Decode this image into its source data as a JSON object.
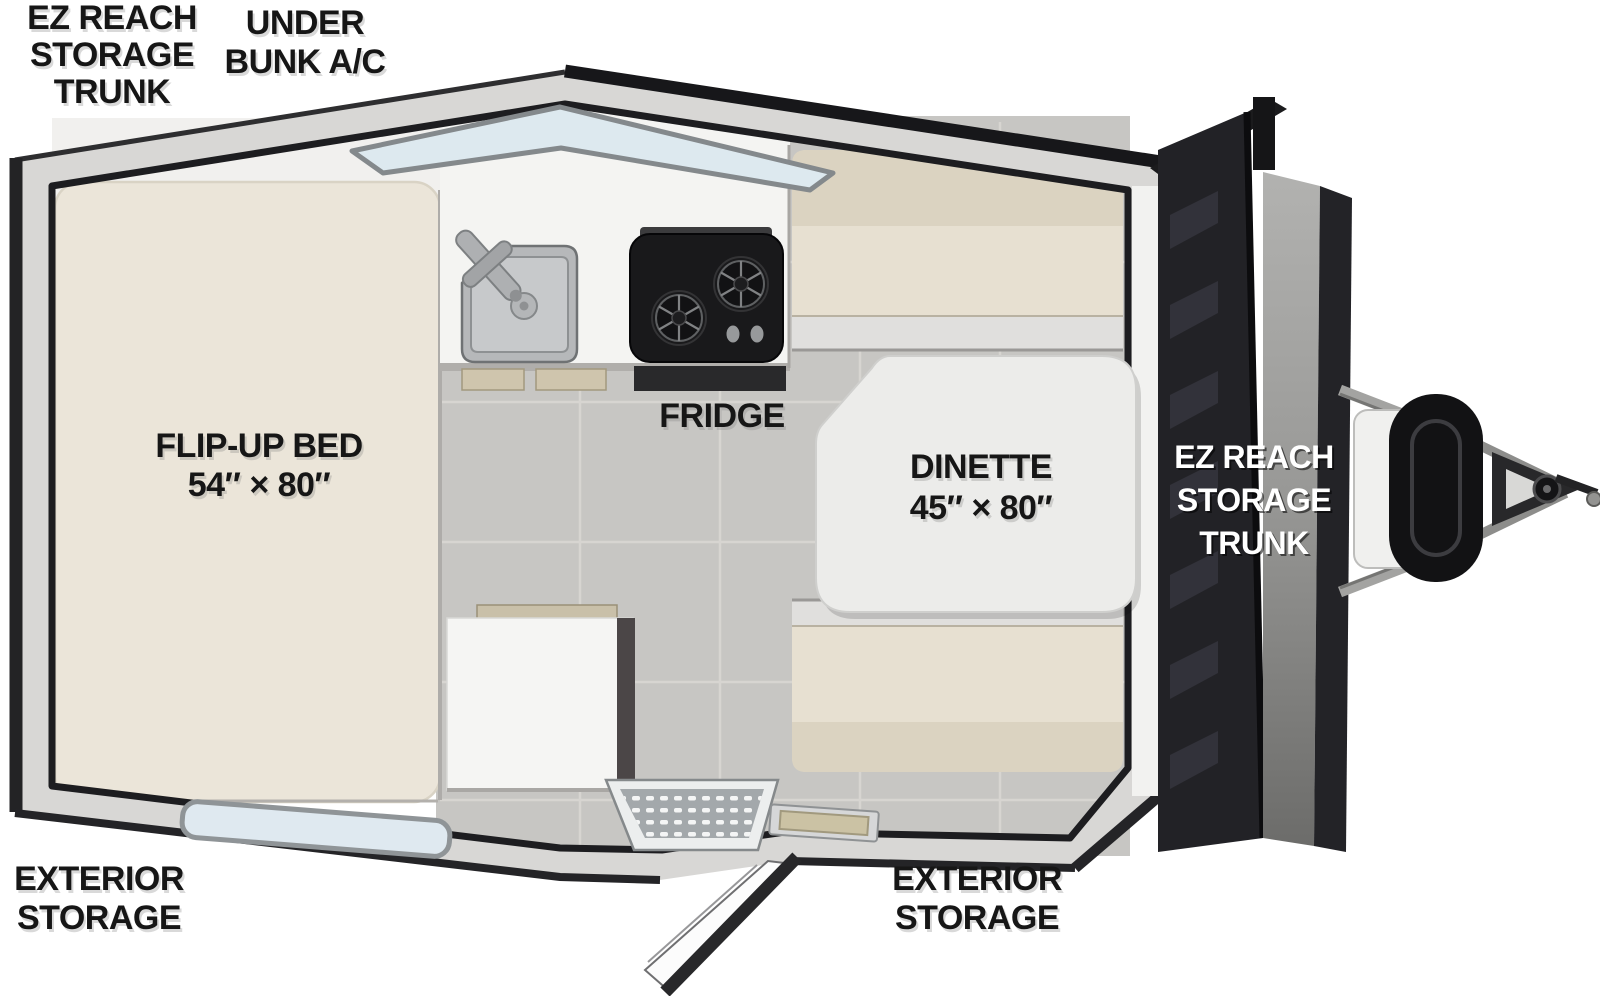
{
  "diagram": {
    "type": "rv-floorplan",
    "callouts": {
      "top_left": {
        "lines": [
          "EZ REACH",
          "STORAGE",
          "TRUNK"
        ]
      },
      "top_center": {
        "lines": [
          "UNDER",
          "BUNK A/C"
        ]
      },
      "bottom_left": {
        "lines": [
          "EXTERIOR",
          "STORAGE"
        ]
      },
      "bottom_right": {
        "lines": [
          "EXTERIOR",
          "STORAGE"
        ]
      }
    },
    "rooms": {
      "bed": {
        "label": "FLIP-UP BED",
        "dimensions": "54″ × 80″"
      },
      "dinette": {
        "label": "DINETTE",
        "dimensions": "45″ × 80″"
      },
      "fridge": {
        "label": "FRIDGE"
      },
      "trunk": {
        "lines": [
          "EZ REACH",
          "STORAGE",
          "TRUNK"
        ]
      }
    },
    "features": [
      "skylight-window",
      "belly-window",
      "sink",
      "faucet",
      "two-burner-cooktop",
      "fridge",
      "dinette-table",
      "dinette-bench-top",
      "dinette-bench-bottom",
      "flip-up-bed",
      "storage-cabinet",
      "entry-step",
      "entry-mat",
      "entry-door",
      "storage-trunk-door",
      "a-frame-tongue",
      "propane-tank",
      "hitch-coupler"
    ],
    "colors": {
      "background": "#ffffff",
      "wall": "#d8d7d5",
      "outline": "#1e1e20",
      "floor": "#c7c6c3",
      "grout": "#d8d6d3",
      "mattress": "#ebe5d9",
      "cushion": "#e7e0d1",
      "cushion_backrest": "#dbd3c1",
      "counter": "#f4f4f2",
      "table": "#ececea",
      "stove": "#19191b",
      "window_glass": "#dde9ef",
      "trunk_door": "#222226",
      "tank": "#121214",
      "label_black": "#161616",
      "label_white": "#ffffff"
    }
  }
}
